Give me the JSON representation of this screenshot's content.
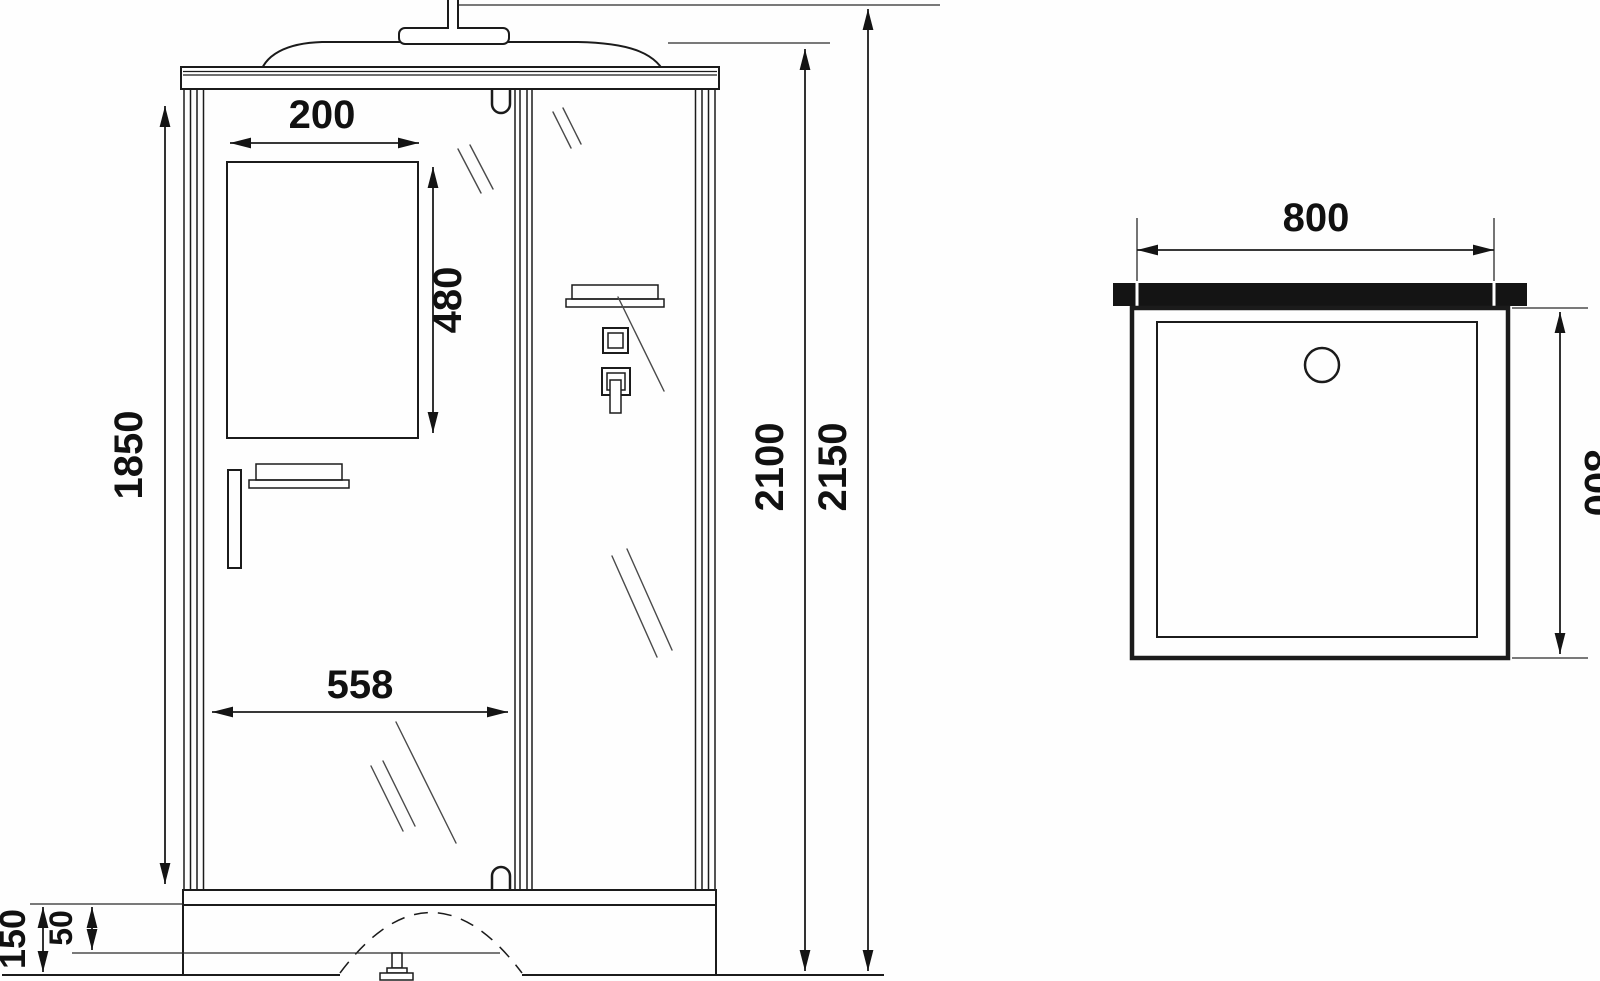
{
  "drawing": {
    "front_view": {
      "dims": {
        "window_width": "200",
        "window_height": "480",
        "door_width": "558",
        "glass_height": "1850",
        "cabin_height": "2100",
        "total_height": "2150",
        "base_height": "150",
        "base_inset": "50"
      }
    },
    "top_view": {
      "dims": {
        "tray_width": "800",
        "tray_depth": "800"
      }
    }
  }
}
